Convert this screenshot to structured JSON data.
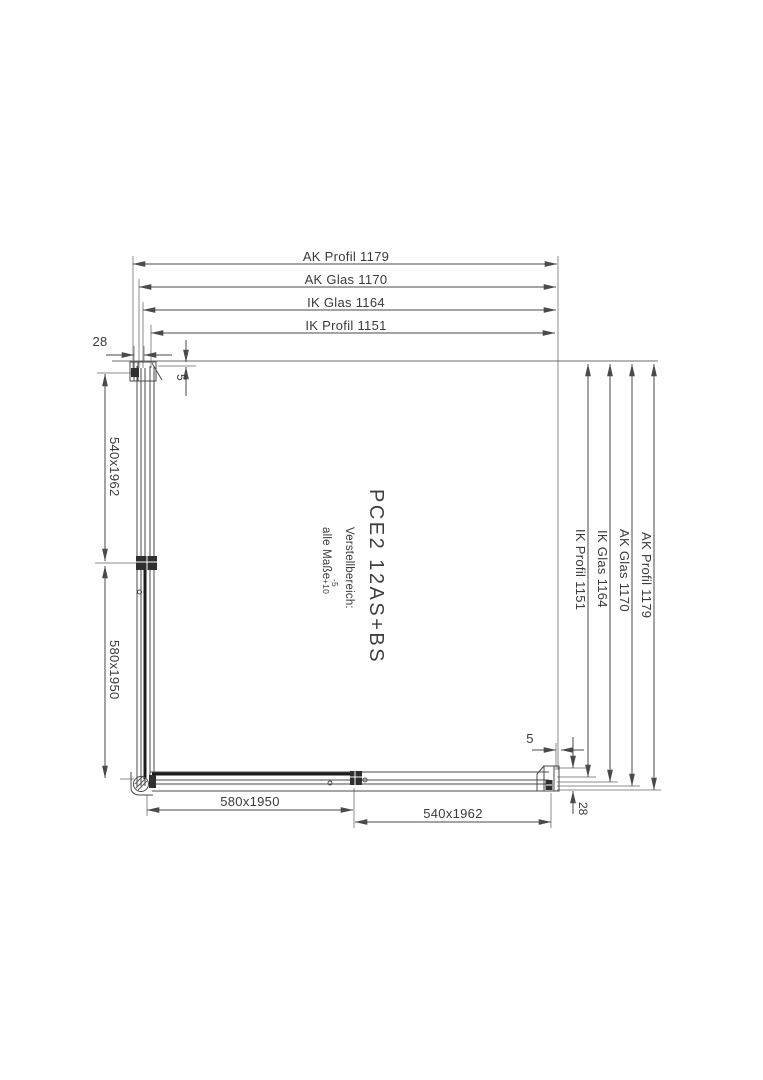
{
  "title_block": {
    "product": "PCE2 12AS+BS",
    "note": {
      "line1": "Verstellbereich:",
      "line2": "alle Maße",
      "tol_minus": "-5",
      "tol_plus": "+10"
    }
  },
  "dimensions": {
    "top": [
      "AK Profil 1179",
      "AK Glas 1170",
      "IK Glas 1164",
      "IK Profil 1151"
    ],
    "right": [
      "AK Profil 1179",
      "AK Glas 1170",
      "IK Glas 1164",
      "IK Profil 1151"
    ],
    "left": [
      "540x1962",
      "580x1950"
    ],
    "bottom": [
      "580x1950",
      "540x1962"
    ],
    "wall_profile_top": "28",
    "wall_profile_bottom": "28",
    "glass_inset_top": "5",
    "glass_inset_bottom": "5"
  },
  "colors": {
    "line": "#4a4a4a",
    "bold_line": "#1c1c1c",
    "extension_line": "#8c8c8c",
    "text": "#3a3a3a",
    "background": "#ffffff"
  }
}
